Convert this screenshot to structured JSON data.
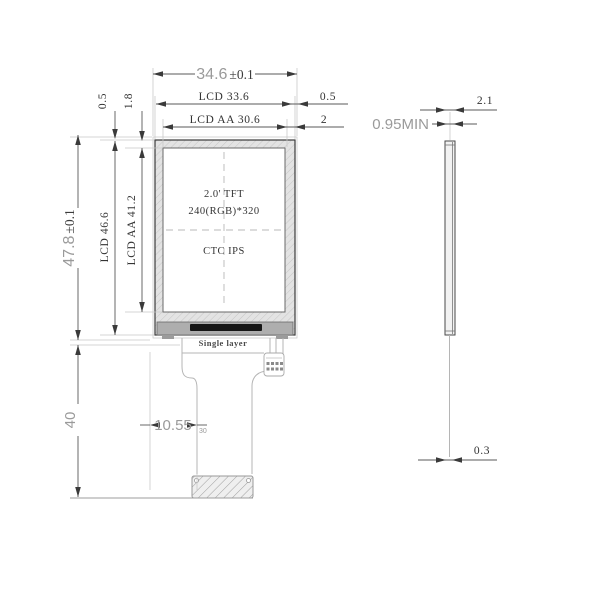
{
  "drawing": {
    "front_view": {
      "screen_label_line1": "2.0' TFT",
      "screen_label_line2": "240(RGB)*320",
      "screen_label_line3": "CTC IPS",
      "flex_label": "Single layer",
      "dim_overall_width": "34.6",
      "dim_overall_width_tol": "±0.1",
      "dim_lcd_width": "LCD 33.6",
      "dim_aa_width": "LCD AA 30.6",
      "dim_right_gap_outer": "0.5",
      "dim_right_gap_aa": "2",
      "dim_overall_height": "47.8",
      "dim_overall_height_tol": "±0.1",
      "dim_lcd_height": "LCD 46.6",
      "dim_aa_height": "LCD AA 41.2",
      "dim_top_gap_outer": "0.5",
      "dim_top_gap_aa": "1.8",
      "dim_flex_length": "40",
      "dim_tail_offset": "10.55",
      "dim_tail_offset_note": "30"
    },
    "side_view": {
      "dim_total_thickness": "2.1",
      "dim_panel_thickness": "0.95MIN",
      "dim_flex_thickness": "0.3"
    },
    "colors": {
      "line_dark": "#3a3a3a",
      "line_dim": "#5a5a5a",
      "line_ext": "#c9c9c9",
      "text_dark": "#333333",
      "text_gray": "#9a9a9a",
      "bezel_fill": "#e3e3e3",
      "ic_fill": "#161616"
    }
  }
}
